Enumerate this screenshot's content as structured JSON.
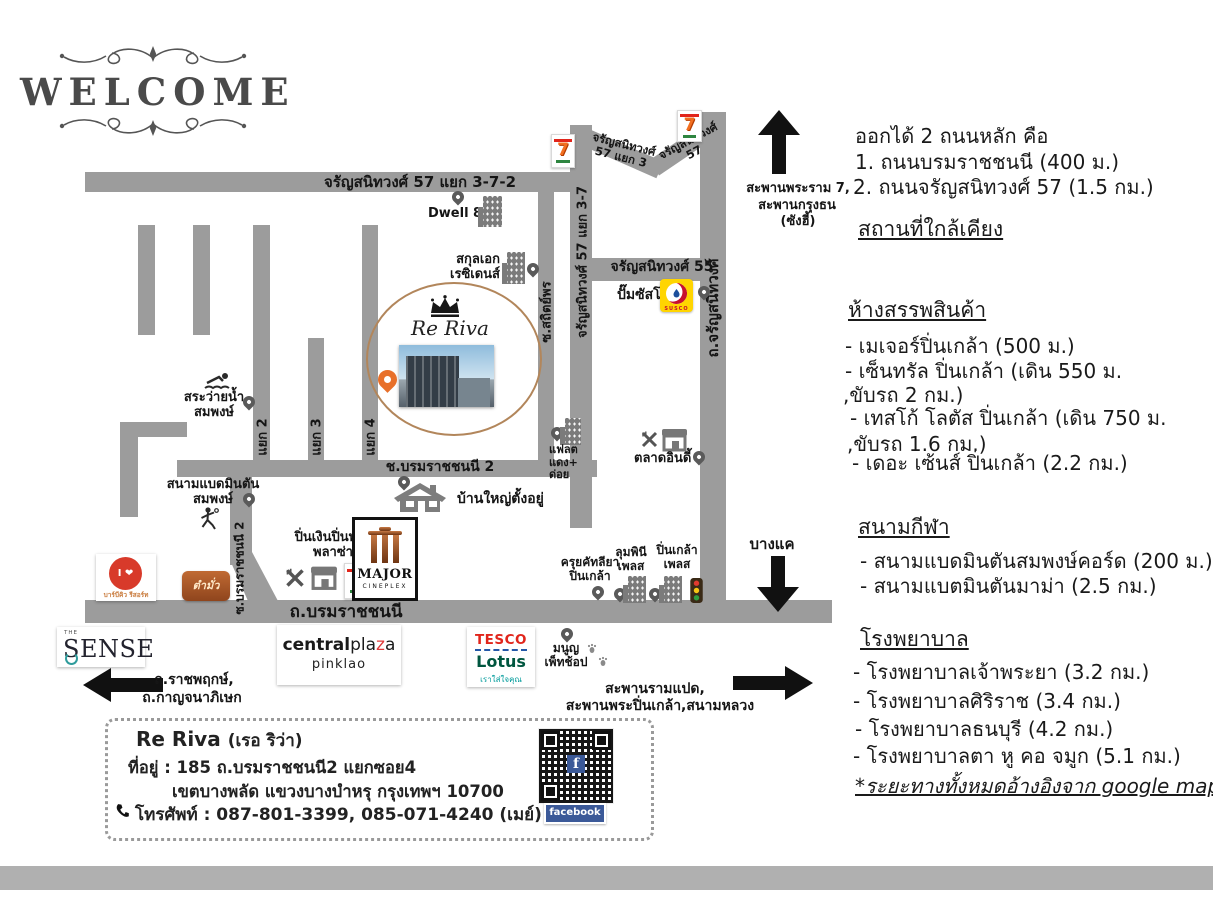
{
  "welcome": {
    "title": "WELCOME"
  },
  "right_panel": {
    "exit": {
      "intro": "ออกได้ 2 ถนนหลัก คือ",
      "option1": "1. ถนนบรมราชชนนี (400 ม.)",
      "option2": "2. ถนนจรัญสนิทวงศ์ 57 (1.5 กม.)"
    },
    "nearby_heading": "สถานที่ใกล้เคียง",
    "malls": {
      "heading": "ห้างสรรพสินค้า",
      "lines": [
        "- เมเจอร์ปิ่นเกล้า (500 ม.)",
        "- เซ็นทรัล ปิ่นเกล้า (เดิน 550 ม.",
        ",ขับรถ 2 กม.)",
        "- เทสโก้ โลตัส ปิ่นเกล้า (เดิน 750 ม.",
        ",ขับรถ 1.6 กม.)",
        "- เดอะ เซ้นส์ ปิ่นเกล้า (2.2 กม.)"
      ]
    },
    "sports": {
      "heading": "สนามกีฬา",
      "lines": [
        "- สนามแบดมินตันสมพงษ์คอร์ด (200 ม.)",
        "- สนามแบตมินตันมาม่า (2.5 กม.)"
      ]
    },
    "hospitals": {
      "heading": "โรงพยาบาล",
      "lines": [
        "- โรงพยาบาลเจ้าพระยา (3.2 กม.)",
        "- โรงพยาบาลศิริราช (3.4 กม.)",
        "- โรงพยาบาลธนบุรี (4.2 กม.)",
        "- โรงพยาบาลตา หู คอ จมูก (5.1 กม.)"
      ]
    },
    "note": "*ระยะทางทั้งหมดอ้างอิงจาก google map*"
  },
  "map": {
    "roads": {
      "top_road": "จรัญสนิทวงศ์ 57 แยก 3-7-2",
      "charan57_yaek3_l1": "จรัญสนิทวงศ์",
      "charan57_yaek3_l2": "57 แยก 3",
      "charan57_l1": "จรัญสนิทวงศ์",
      "charan57_l2": "57",
      "charan57_37": "จรัญสนิทวงศ์ 57 แยก 3-7",
      "sathit_phon": "ซ.สถิตย์พร",
      "charan_main": "ถ.จรัญสนิทวงศ์",
      "charan55": "จรัญสนิทวงศ์ 55",
      "yaek2": "แยก 2",
      "yaek3": "แยก 3",
      "yaek4": "แยก 4",
      "soi_borom2": "ช.บรมราชชนนี 2",
      "soi_borom2_vert": "ซ.บรมราชชนนี 2",
      "borom_main": "ถ.บรมราชชนนี"
    },
    "directions": {
      "north_l1": "สะพานพระราม 7,",
      "north_l2": "สะพานกรุงธน",
      "north_l3": "(ซังฮี้)",
      "south": "บางแค",
      "west_l1": "ถ.ราชพฤกษ์,",
      "west_l2": "ถ.กาญจนาภิเษก",
      "east_l1": "สะพานรามแปด,",
      "east_l2": "สะพานพระปิ่นเกล้า,สนามหลวง"
    },
    "places": {
      "dwell": "Dwell 811",
      "sakul_ek_l1": "สกุลเอก",
      "sakul_ek_l2": "เรซิเดนส์",
      "re_riva": "Re Riva",
      "susco": "ปั๊มซัสโก้",
      "pool_l1": "สระว่ายน้ำ",
      "pool_l2": "สมพงษ์",
      "badminton_l1": "สนามแบดมินตัน",
      "badminton_l2": "สมพงษ์",
      "flat_l1": "แฟลต",
      "flat_l2": "แดง+",
      "flat_l3": "ด่อย",
      "market": "ตลาดอินดี้",
      "big_house": "บ้านใหญ่ตั้งอยู่",
      "pin_ngoen_l1": "ปิ่นเงินปิ่นทอง",
      "pin_ngoen_l2": "พลาซ่า",
      "khrui_l1": "ครุยคัทลียา",
      "khrui_l2": "ปิ่นเกล้า",
      "lumpini_l1": "ลุมพินี",
      "lumpini_l2": "เพลส",
      "pinklao_place_l1": "ปิ่นเกล้า",
      "pinklao_place_l2": "เพลส",
      "manun_l1": "มนูญ",
      "manun_l2": "เพ็ทช้อป"
    }
  },
  "logos": {
    "seven": "7",
    "susco_text": "SUSCO",
    "major_l1": "MAJOR",
    "major_l2": "CINEPLEX",
    "central_a": "central",
    "central_b": "pla",
    "central_c": "z",
    "central_d": "a",
    "central_sub": "pinklao",
    "tesco": "TESCO",
    "lotus": "Lotus",
    "tesco_sub": "เราใส่ใจคุณ",
    "sense_the": "THE",
    "sense": "SENSE",
    "bbq_top": "I ❤",
    "bbq_caption": "บาร์บีคิว รีสอร์ท",
    "tam_logo": "ตำมั่ว",
    "facebook": "facebook"
  },
  "info_box": {
    "title": "Re Riva",
    "title_sub": "(เรอ ริว่า)",
    "address_l1": "ที่อยู่ : 185 ถ.บรมราชชนนี2 แยกซอย4",
    "address_l2": "เขตบางพลัด แขวงบางบำหรุ กรุงเทพฯ 10700",
    "phone": "โทรศัพท์ : 087-801-3399, 085-071-4240 (เมย์)"
  },
  "colors": {
    "road": "#9c9c9c",
    "accent_orange": "#e8702a",
    "susco_yellow": "#ffd500",
    "tesco_red": "#e1251b",
    "lotus_green": "#00563f",
    "facebook_blue": "#3b5998"
  }
}
